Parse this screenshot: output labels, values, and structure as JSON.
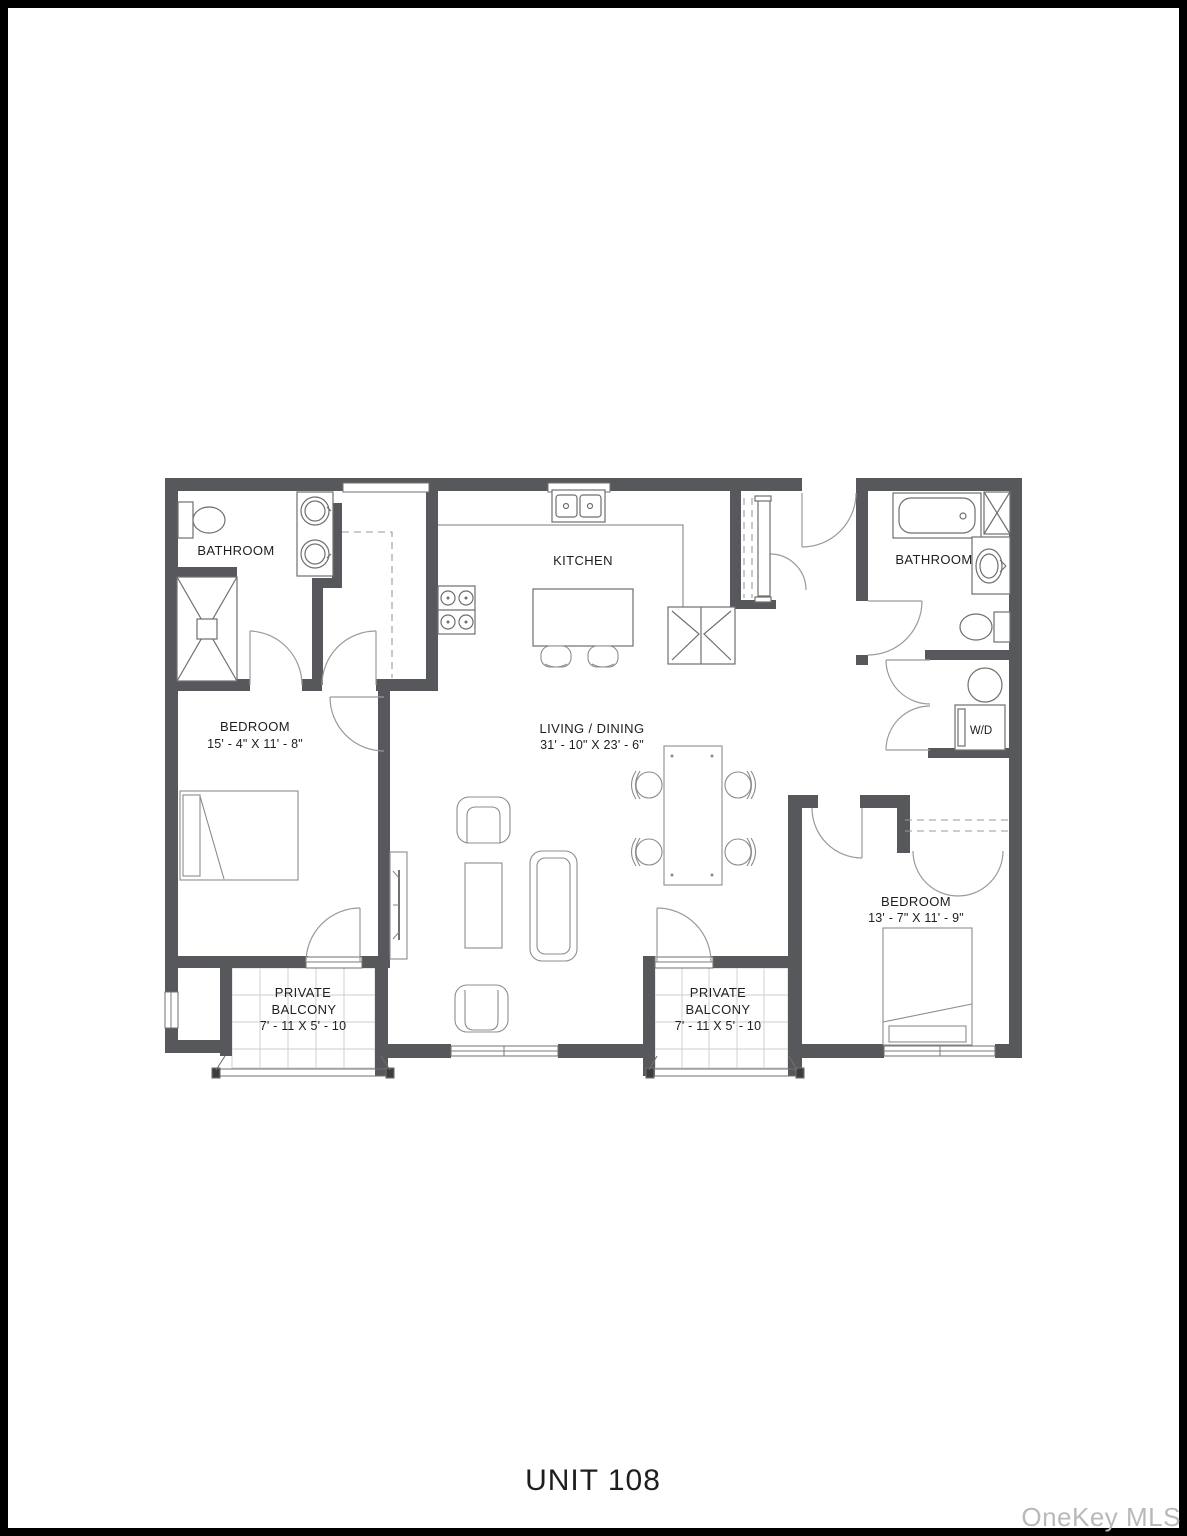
{
  "page": {
    "unit_label": "UNIT 108",
    "watermark": "OneKey MLS"
  },
  "colors": {
    "wall": "#57585B",
    "frame": "#000000",
    "fixture_line": "#6F6F6F",
    "furniture_line": "#8C8C8C",
    "door_swing": "#9A9A9A",
    "balcony_tile": "#CDCDCD",
    "label_text": "#1E1E1E",
    "watermark_text": "#B9B9B9"
  },
  "rooms": {
    "bathroom_left": {
      "name": "BATHROOM"
    },
    "kitchen": {
      "name": "KITCHEN"
    },
    "bathroom_right": {
      "name": "BATHROOM"
    },
    "bedroom_left": {
      "name": "BEDROOM",
      "dimensions": "15' - 4\" X 11' - 8\""
    },
    "living_dining": {
      "name": "LIVING / DINING",
      "dimensions": "31' - 10\" X 23' - 6\""
    },
    "bedroom_right": {
      "name": "BEDROOM",
      "dimensions": "13' - 7\" X 11' - 9\""
    },
    "balcony_left": {
      "name_line1": "PRIVATE",
      "name_line2": "BALCONY",
      "dimensions": "7' - 11 X 5' - 10"
    },
    "balcony_right": {
      "name_line1": "PRIVATE",
      "name_line2": "BALCONY",
      "dimensions": "7' - 11 X 5' - 10"
    },
    "laundry_closet": {
      "name": "W/D"
    }
  }
}
